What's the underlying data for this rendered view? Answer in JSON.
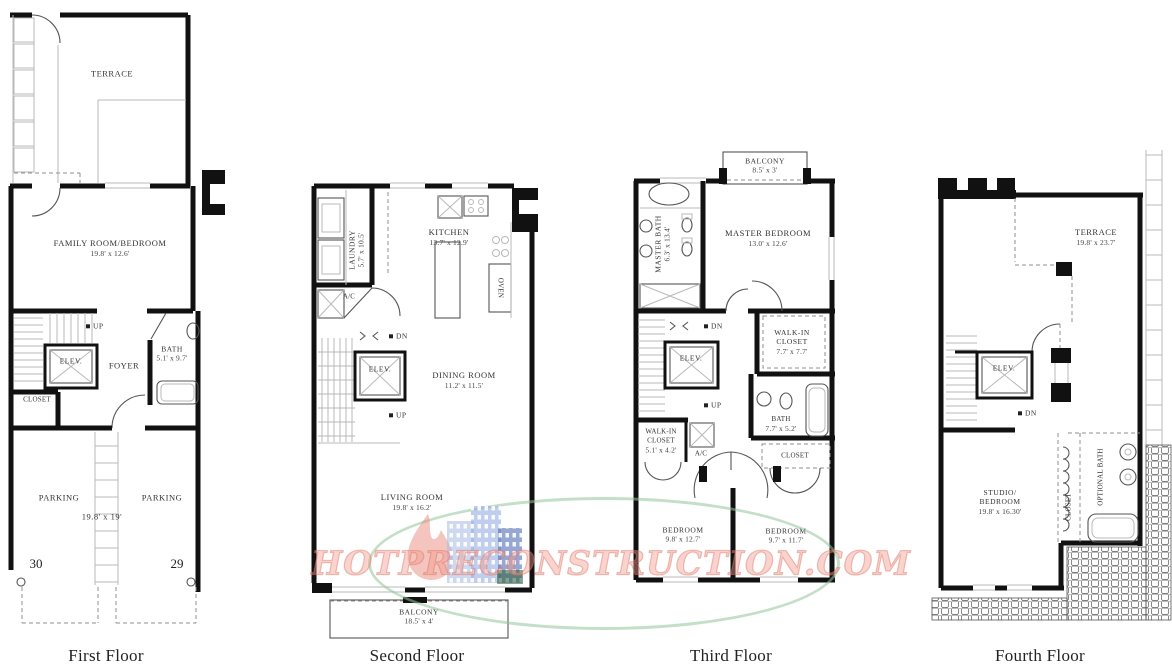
{
  "watermark": {
    "text": "HOTPRECONSTRUCTION.COM",
    "text_color": "#E89486",
    "ellipse_color": "#96C49B",
    "flame_color": "#E07B68",
    "buildings_color": "#96AEE0"
  },
  "floors": {
    "first": {
      "title": "First Floor",
      "terrace": "TERRACE",
      "family_room": "FAMILY ROOM/BEDROOM",
      "family_room_dims": "19.8' x 12.6'",
      "up": "UP",
      "elevator": "ELEV.",
      "foyer": "FOYER",
      "bath": "BATH",
      "bath_dims": "5.1' x 9.7'",
      "closet": "CLOSET",
      "parking_left": "PARKING",
      "parking_right": "PARKING",
      "parking_dims": "19.8' x 19'",
      "space_left": "30",
      "space_right": "29"
    },
    "second": {
      "title": "Second Floor",
      "laundry": "LAUNDRY",
      "laundry_dims": "5.7' x 10.5'",
      "kitchen": "KITCHEN",
      "kitchen_dims": "13.7' x 12.9'",
      "oven": "OVEN",
      "ac": "A/C",
      "dn": "DN",
      "elevator": "ELEV.",
      "dining_room": "DINING ROOM",
      "dining_room_dims": "11.2' x 11.5'",
      "up": "UP",
      "living_room": "LIVING ROOM",
      "living_room_dims": "19.8' x 16.2'",
      "balcony": "BALCONY",
      "balcony_dims": "18.5' x 4'"
    },
    "third": {
      "title": "Third Floor",
      "balcony": "BALCONY",
      "balcony_dims": "8.5' x 3'",
      "master_bath": "MASTER BATH",
      "master_bath_dims": "6.3' x 13.4'",
      "master_bedroom": "MASTER BEDROOM",
      "master_bedroom_dims": "13.0' x 12.6'",
      "dn": "DN",
      "elevator": "ELEV.",
      "walkin_right_line1": "WALK-IN",
      "walkin_right_line2": "CLOSET",
      "walkin_right_dims": "7.7' x 7.7'",
      "up": "UP",
      "walkin_left_line1": "WALK-IN",
      "walkin_left_line2": "CLOSET",
      "walkin_left_dims": "5.1' x 4.2'",
      "ac": "A/C",
      "bath": "BATH",
      "bath_dims": "7.7' x 5.2'",
      "closet": "CLOSET",
      "bedroom_left": "BEDROOM",
      "bedroom_left_dims": "9.8' x 12.7'",
      "bedroom_right": "BEDROOM",
      "bedroom_right_dims": "9.7' x 11.7'"
    },
    "fourth": {
      "title": "Fourth Floor",
      "terrace": "TERRACE",
      "terrace_dims": "19.8' x 23.7'",
      "elevator": "ELEV.",
      "dn": "DN",
      "studio_line1": "STUDIO/",
      "studio_line2": "BEDROOM",
      "studio_dims": "19.8' x 16.30'",
      "closet": "CLOSET",
      "optional_bath": "OPTIONAL BATH"
    }
  }
}
